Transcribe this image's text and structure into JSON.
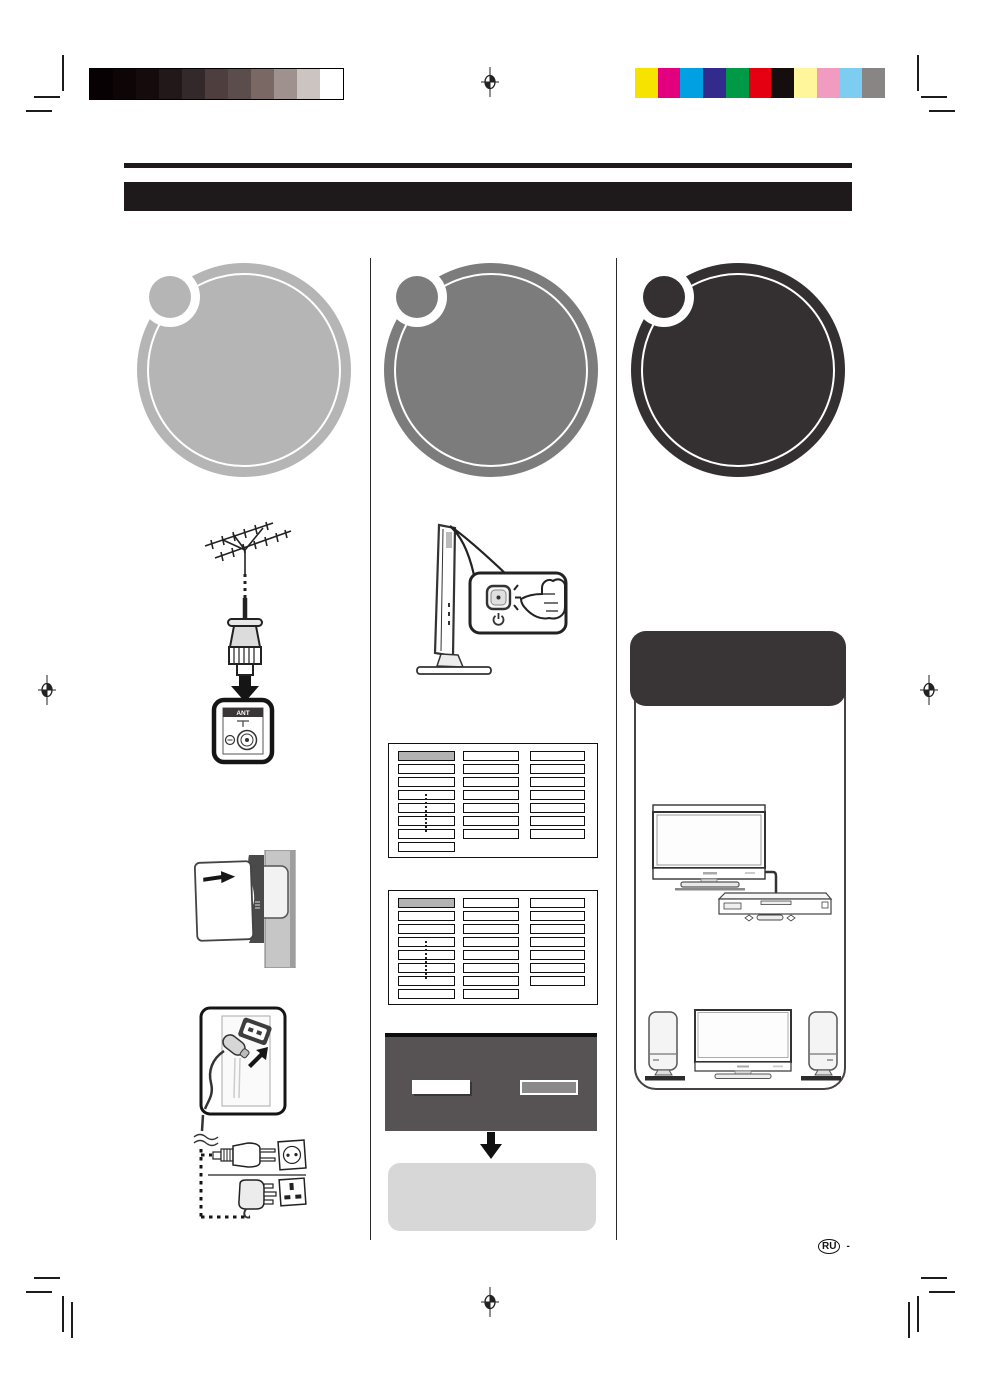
{
  "print_calibration": {
    "grayscale_swatches": [
      "#070103",
      "#0d0506",
      "#150b0c",
      "#221819",
      "#33292a",
      "#4e3e3d",
      "#5b4d4c",
      "#796864",
      "#9f928e",
      "#cbc4c0",
      "#ffffff"
    ],
    "color_swatches": [
      "#f6e400",
      "#e2007e",
      "#00a0e2",
      "#322a8d",
      "#009a47",
      "#e40011",
      "#150d0e",
      "#fff59b",
      "#f19bc0",
      "#7dcdf2",
      "#8a8585"
    ]
  },
  "header": {
    "rule_color": "#1e1a1b",
    "bar_color": "#1e1a1b"
  },
  "steps": [
    {
      "id": 1,
      "color": "#b5b5b5"
    },
    {
      "id": 2,
      "color": "#7c7c7c"
    },
    {
      "id": 3,
      "color": "#342f31"
    }
  ],
  "antenna_jack": {
    "label": "ANT"
  },
  "channel_tables": [
    {
      "column_cell_counts": [
        8,
        7,
        7
      ],
      "first_cell_highlight": "#b3b3b3"
    },
    {
      "column_cell_counts": [
        8,
        8,
        7
      ],
      "first_cell_highlight": "#b3b3b3"
    }
  ],
  "menu_panel": {
    "bg": "#575354",
    "selected_button_color": "#ffffff",
    "secondary_button_color": "#8a8a8a"
  },
  "result_panel": {
    "bg": "#d7d7d7"
  },
  "connections_panel": {
    "header_color": "#393536"
  },
  "footer": {
    "language_code": "RU",
    "suffix": "-"
  }
}
